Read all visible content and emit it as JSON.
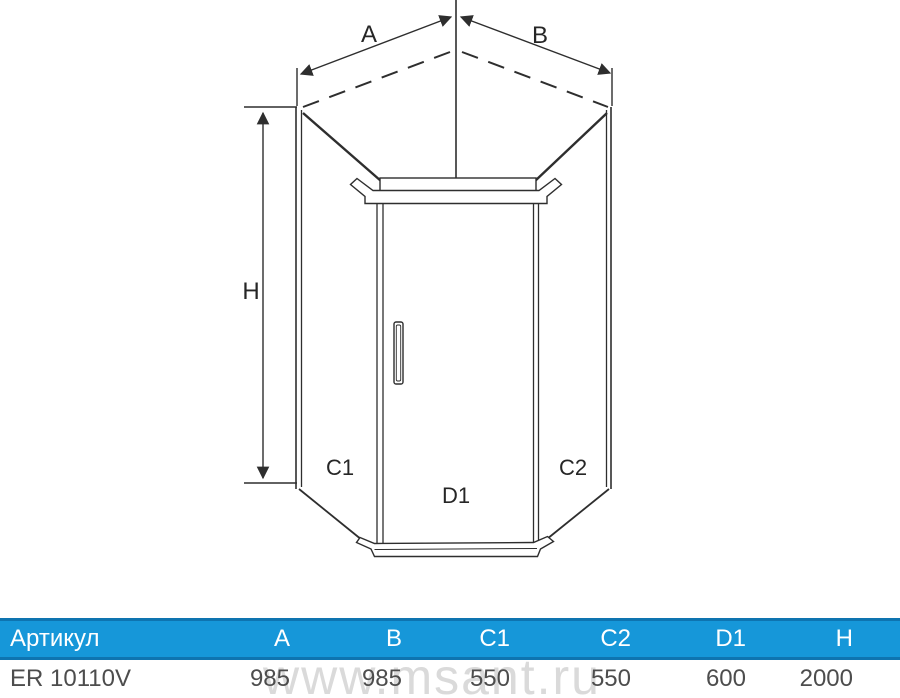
{
  "diagram": {
    "labels": {
      "a": "A",
      "b": "B",
      "h": "H",
      "c1": "C1",
      "d1": "D1",
      "c2": "C2"
    }
  },
  "watermark": {
    "text": "www.msant.ru"
  },
  "table": {
    "header": [
      "Артикул",
      "A",
      "B",
      "C1",
      "C2",
      "D1",
      "H"
    ],
    "rows": [
      [
        "ER 10110V",
        "985",
        "985",
        "550",
        "550",
        "600",
        "2000"
      ]
    ]
  },
  "colors": {
    "header_blue": "#1697d9",
    "header_border_blue": "#0e74b0",
    "line_color": "#2e2e2e",
    "value_text": "#4d4d4d",
    "watermark_grey": "#dadada"
  }
}
